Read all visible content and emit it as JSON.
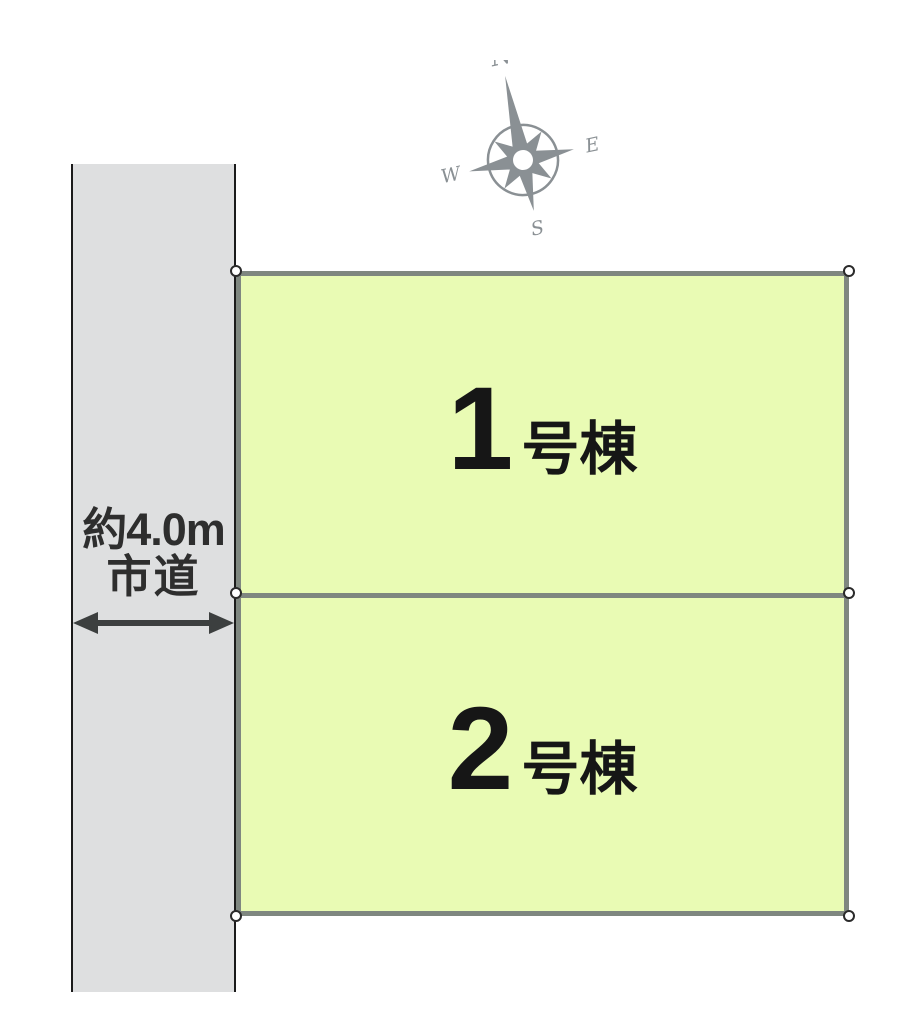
{
  "diagram_title": "",
  "road": {
    "width_label": "約4.0m",
    "name_label": "市道"
  },
  "plots": [
    {
      "number": "1",
      "suffix": "号棟"
    },
    {
      "number": "2",
      "suffix": "号棟"
    }
  ],
  "compass": {
    "north": "N",
    "east": "E",
    "south": "S",
    "west": "W"
  },
  "colors": {
    "plot_fill": "#e9fbb4",
    "plot_border": "#7f8780",
    "road_fill": "#dedfe0",
    "road_edge": "#1b1b1b",
    "annotation_text": "#2e2e2e",
    "arrow": "#3c3f3f",
    "compass": "#8a9094",
    "plot_text": "#161616",
    "vertex_fill": "#ffffff",
    "vertex_stroke": "#2a2a2a"
  }
}
